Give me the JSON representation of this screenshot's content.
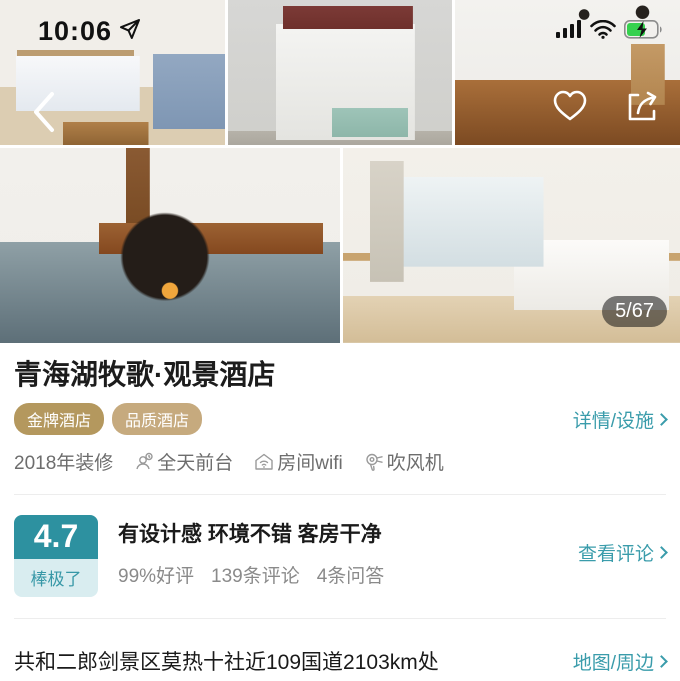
{
  "status_bar": {
    "time": "10:06"
  },
  "gallery": {
    "counter": "5/67"
  },
  "hotel": {
    "name": "青海湖牧歌·观景酒店",
    "badges": [
      "金牌酒店",
      "品质酒店"
    ],
    "details_link": "详情/设施",
    "features": [
      {
        "label": "2018年装修",
        "icon": ""
      },
      {
        "label": "全天前台",
        "icon": "front-desk-icon"
      },
      {
        "label": "房间wifi",
        "icon": "room-wifi-icon"
      },
      {
        "label": "吹风机",
        "icon": "hairdryer-icon"
      }
    ]
  },
  "rating": {
    "score": "4.7",
    "level": "棒极了",
    "headline": "有设计感 环境不错 客房干净",
    "stats": [
      "99%好评",
      "139条评论",
      "4条问答"
    ],
    "reviews_link": "查看评论"
  },
  "location": {
    "address": "共和二郎剑景区莫热十社近109国道2103km处",
    "map_link": "地图/周边"
  },
  "colors": {
    "accent_teal": "#3a9cab",
    "rating_box_bg": "#2d91a0",
    "rating_label_bg": "#d9edf0",
    "badge_gold": "#b4985e",
    "badge_light_gold": "#c6aa7e",
    "battery_green": "#35d14e",
    "counter_bg": "rgba(20,20,20,0.55)"
  }
}
